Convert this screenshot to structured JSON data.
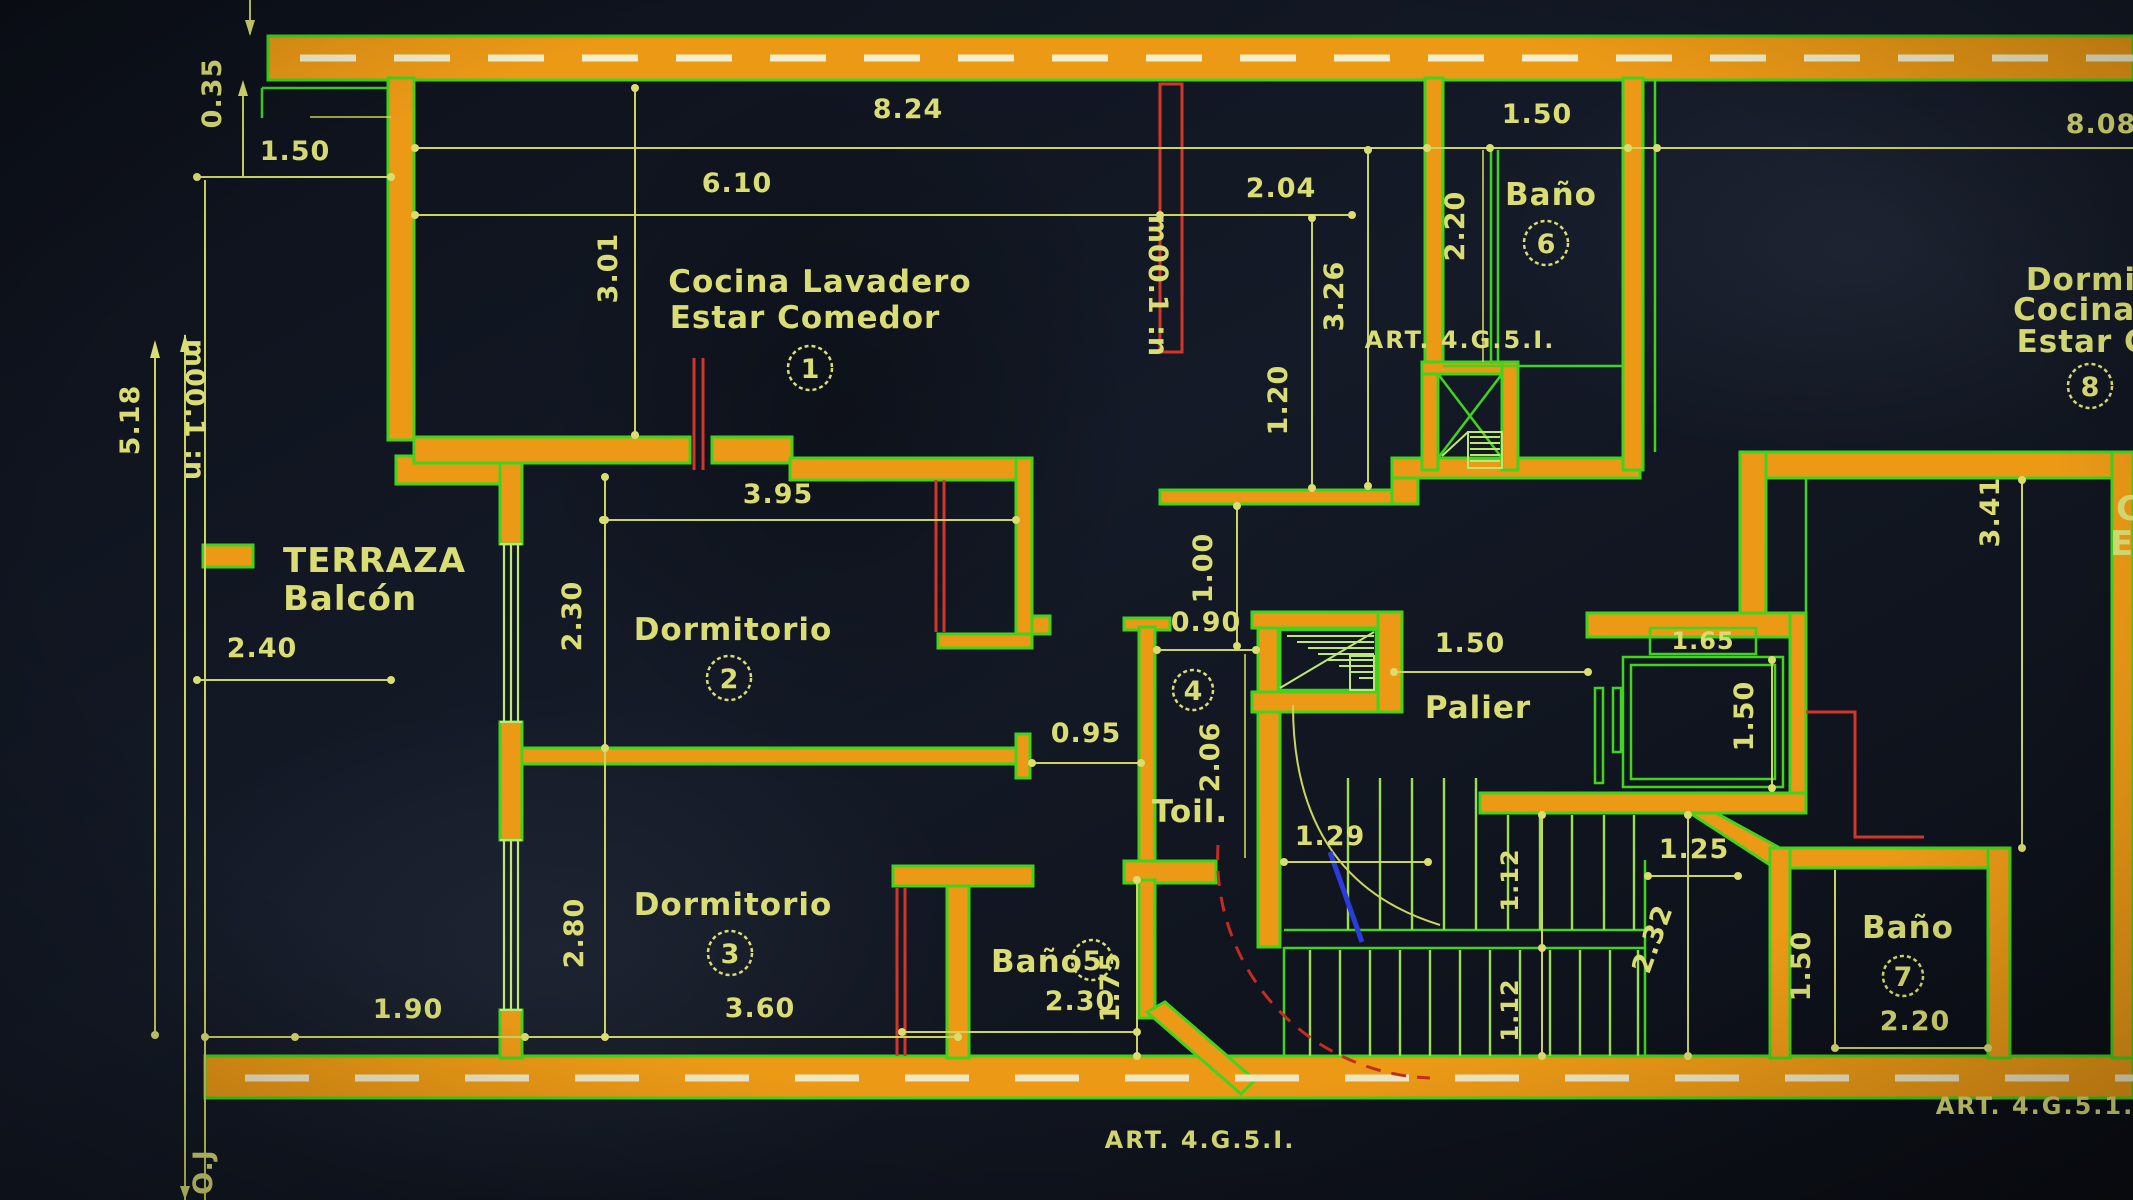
{
  "colors": {
    "background": "#101521",
    "wall_fill": "#ec9a16",
    "wall_edge": "#41d41e",
    "dimension": "#ccd35e",
    "text": "#d9dd74",
    "red_accent": "#d23529",
    "blue_accent": "#2b3bdc",
    "wall_dash": "#f3eecb"
  },
  "rooms": {
    "unit1": {
      "line1": "Cocina Lavadero",
      "line2": "Estar Comedor",
      "number": "1"
    },
    "dorm2": {
      "name": "Dormitorio",
      "number": "2"
    },
    "dorm3": {
      "name": "Dormitorio",
      "number": "3"
    },
    "toilette": {
      "name": "Toil.",
      "number": "4"
    },
    "bano5": {
      "name": "Baño",
      "number": "5"
    },
    "bano6": {
      "name": "Baño",
      "number": "6"
    },
    "bano7": {
      "name": "Baño",
      "number": "7"
    },
    "unit8": {
      "line1": "Dormito",
      "line2": "Cocina Lav",
      "line3": "Estar Com",
      "number": "8"
    },
    "terraza": {
      "line1": "TERRAZA",
      "line2": "Balcón"
    },
    "palier": {
      "name": "Palier"
    },
    "right_cut": {
      "line1": "C",
      "line2": "E"
    }
  },
  "dims": {
    "v035": "0.35",
    "h150_balc": "1.50",
    "h824": "8.24",
    "h610": "6.10",
    "h204": "2.04",
    "h150_b6": "1.50",
    "h808": "8.08",
    "v301": "3.01",
    "v326": "3.26",
    "v220_b6": "2.20",
    "v518": "5.18",
    "h240": "2.40",
    "h395": "3.95",
    "v230_d2": "2.30",
    "v280_d3": "2.80",
    "v100": "1.00",
    "h090": "0.90",
    "h095": "0.95",
    "v206": "2.06",
    "h150_pal": "1.50",
    "h165_lift": "1.65",
    "v150_lift": "1.50",
    "v120": "1.20",
    "v341": "3.41",
    "h190": "1.90",
    "h360": "3.60",
    "h230_b5": "2.30",
    "v175": "1.75",
    "h129": "1.29",
    "v112a": "1.12",
    "v112b": "1.12",
    "v232": "2.32",
    "h125": "1.25",
    "v150_b7": "1.50",
    "h220_b7": "2.20"
  },
  "notes": {
    "art_mid": "ART. 4.G.5.I.",
    "art_bottom": "ART. 4.G.5.I.",
    "art_bottom_right": "ART. 4.G.5.1.",
    "level_right": "m00.1 :n",
    "level_left": "m00.1 :n",
    "corner": "O.J"
  }
}
